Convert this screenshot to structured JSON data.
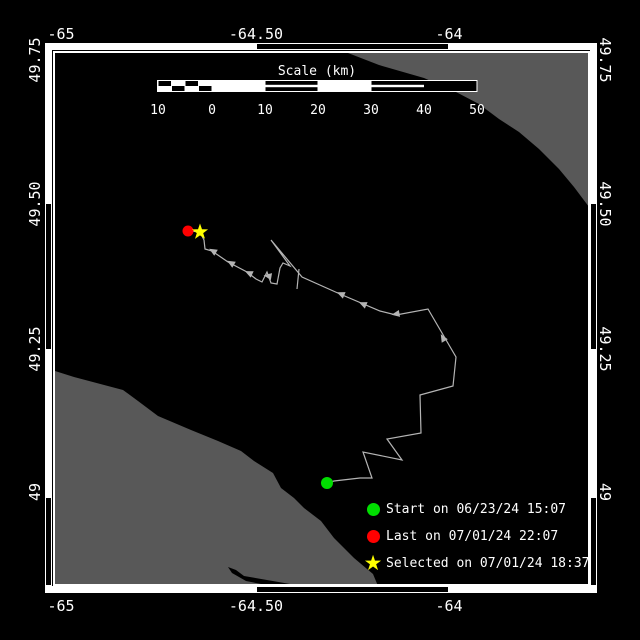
{
  "colors": {
    "background": "#000000",
    "water": "#000000",
    "land": "#585858",
    "track": "#b4b4b4",
    "frame": "#ffffff",
    "text": "#ffffff",
    "start": "#00dd00",
    "last": "#ff0000",
    "selected": "#ffff00"
  },
  "axes": {
    "x_ticks": [
      {
        "label": "-65",
        "px": 61
      },
      {
        "label": "-64.50",
        "px": 256
      },
      {
        "label": "-64",
        "px": 449
      }
    ],
    "y_ticks": [
      {
        "label": "49.75",
        "px": 60
      },
      {
        "label": "49.50",
        "px": 204
      },
      {
        "label": "49.25",
        "px": 349
      },
      {
        "label": "49",
        "px": 492
      }
    ]
  },
  "border": {
    "h_segments": [
      {
        "from": 45,
        "to": 256,
        "style": "white"
      },
      {
        "from": 256,
        "to": 449,
        "style": "black"
      },
      {
        "from": 449,
        "to": 597,
        "style": "white"
      }
    ],
    "v_segments": [
      {
        "from": 43,
        "to": 203,
        "style": "white"
      },
      {
        "from": 203,
        "to": 350,
        "style": "black"
      },
      {
        "from": 350,
        "to": 497,
        "style": "white"
      },
      {
        "from": 497,
        "to": 586,
        "style": "black"
      }
    ]
  },
  "scalebar": {
    "title": "Scale (km)",
    "tick_labels": [
      "10",
      "0",
      "10",
      "20",
      "30",
      "40",
      "50"
    ],
    "tick_px": [
      158,
      212,
      265,
      318,
      371,
      424,
      477
    ],
    "bar_top": 81,
    "bar_bottom": 91,
    "title_y": 75,
    "labels_y": 114
  },
  "legend": {
    "items": [
      {
        "marker": "circle",
        "color": "#00dd00",
        "label": "Start on 06/23/24 15:07"
      },
      {
        "marker": "circle",
        "color": "#ff0000",
        "label": "Last on 07/01/24 22:07"
      },
      {
        "marker": "star",
        "color": "#ffff00",
        "label": "Selected on 07/01/24 18:37"
      }
    ]
  },
  "map": {
    "markers": {
      "start": {
        "x": 327,
        "y": 483
      },
      "last": {
        "x": 188,
        "y": 231
      },
      "selected": {
        "x": 200,
        "y": 232
      }
    },
    "track": [
      [
        327,
        483
      ],
      [
        334,
        481
      ],
      [
        360,
        478
      ],
      [
        372,
        478
      ],
      [
        363,
        452
      ],
      [
        402,
        460
      ],
      [
        387,
        439
      ],
      [
        421,
        433
      ],
      [
        420,
        395
      ],
      [
        453,
        386
      ],
      [
        456,
        357
      ],
      [
        428,
        309
      ],
      [
        396,
        315
      ],
      [
        380,
        311
      ],
      [
        340,
        294
      ],
      [
        302,
        277
      ],
      [
        271,
        240
      ],
      [
        290,
        266
      ],
      [
        283,
        263
      ],
      [
        280,
        268
      ],
      [
        277,
        284
      ],
      [
        271,
        283
      ],
      [
        267,
        272
      ],
      [
        262,
        282
      ],
      [
        256,
        279
      ],
      [
        247,
        272
      ],
      [
        228,
        262
      ],
      [
        212,
        251
      ],
      [
        205,
        249
      ],
      [
        204,
        240
      ],
      [
        200,
        232
      ],
      [
        191,
        231
      ]
    ],
    "track_tail": [
      [
        299,
        269
      ],
      [
        297,
        289
      ]
    ],
    "arrows": [
      {
        "x": 213,
        "y": 251,
        "a": -150
      },
      {
        "x": 231,
        "y": 263,
        "a": -150
      },
      {
        "x": 249,
        "y": 273,
        "a": -155
      },
      {
        "x": 268,
        "y": 276,
        "a": -170
      },
      {
        "x": 341,
        "y": 294,
        "a": -157
      },
      {
        "x": 363,
        "y": 304,
        "a": -157
      },
      {
        "x": 396,
        "y": 314,
        "a": 170
      },
      {
        "x": 443,
        "y": 338,
        "a": -120
      }
    ],
    "land": [
      [
        [
          348,
          53
        ],
        [
          589,
          53
        ],
        [
          589,
          207
        ],
        [
          574,
          187
        ],
        [
          559,
          169
        ],
        [
          539,
          149
        ],
        [
          519,
          132
        ],
        [
          499,
          119
        ],
        [
          479,
          104
        ],
        [
          456,
          92
        ],
        [
          424,
          78
        ],
        [
          379,
          65
        ]
      ],
      [
        [
          55,
          371
        ],
        [
          74,
          377
        ],
        [
          123,
          390
        ],
        [
          138,
          401
        ],
        [
          158,
          416
        ],
        [
          191,
          430
        ],
        [
          218,
          441
        ],
        [
          241,
          451
        ],
        [
          254,
          461
        ],
        [
          273,
          473
        ],
        [
          281,
          488
        ],
        [
          294,
          498
        ],
        [
          304,
          508
        ],
        [
          321,
          521
        ],
        [
          334,
          538
        ],
        [
          354,
          558
        ],
        [
          373,
          574
        ],
        [
          378,
          586
        ],
        [
          55,
          586
        ]
      ]
    ],
    "inlet": [
      [
        228,
        567
      ],
      [
        236,
        570
      ],
      [
        244,
        576
      ],
      [
        290,
        584
      ],
      [
        298,
        589
      ],
      [
        286,
        589
      ],
      [
        246,
        581
      ],
      [
        232,
        573
      ]
    ]
  }
}
